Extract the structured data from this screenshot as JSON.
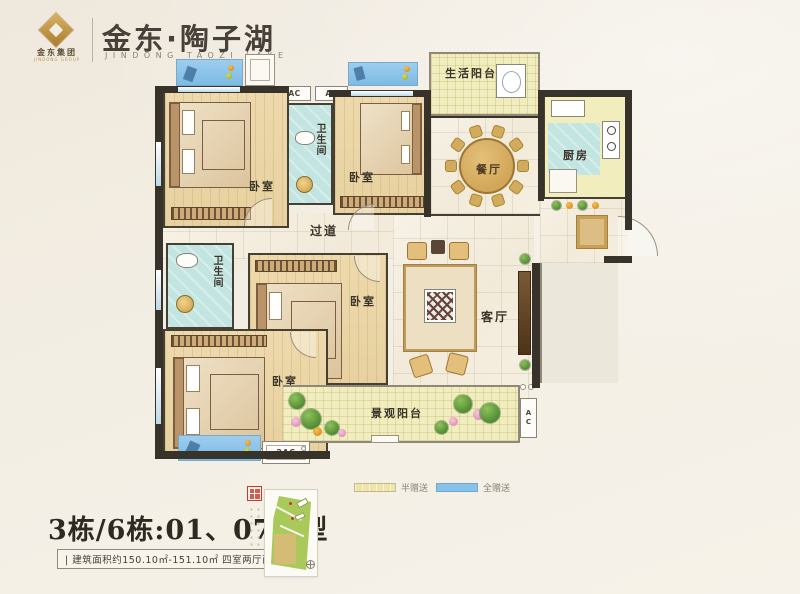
{
  "header": {
    "group_name": "金东集团",
    "group_name_en": "JINDONG GROUP",
    "title": "金东·陶子湖",
    "subtitle": "JINDONG TAOZI LAKE"
  },
  "plan": {
    "rooms": {
      "bedroom1": "卧室",
      "bath1": "卫生间",
      "bedroom2": "卧室",
      "life_balcony": "生活阳台",
      "dining": "餐厅",
      "kitchen": "厨房",
      "corridor": "过道",
      "bath2": "卫生间",
      "bedroom3": "卧室",
      "bedroom4": "卧室",
      "living": "客厅",
      "view_balcony": "景观阳台"
    },
    "ac_labels": {
      "ac1": "AC",
      "ac2": "AC",
      "ac_bottom": "2AC",
      "ac_right": "AC"
    }
  },
  "legend": {
    "half_gift": {
      "label": "半赠送",
      "color": "#ece4a8"
    },
    "full_gift": {
      "label": "全赠送",
      "color": "#86c2e9"
    }
  },
  "footer": {
    "unit_title": "3栋/6栋:01、07户型",
    "area_line": "| 建筑面积约150.10㎡-151.10㎡  四室两厅两卫 |"
  }
}
